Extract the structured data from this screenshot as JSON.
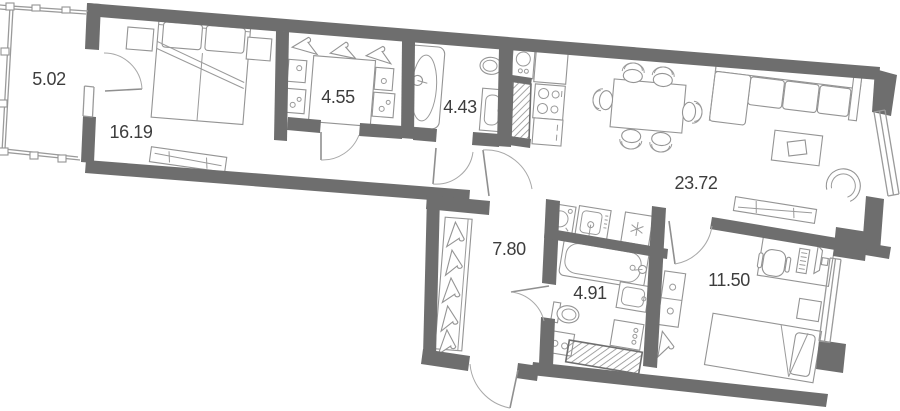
{
  "plan": {
    "type": "apartment-floor-plan",
    "rooms": [
      {
        "name": "balcony",
        "area_label": "5.02"
      },
      {
        "name": "bedroom",
        "area_label": "16.19"
      },
      {
        "name": "wardrobe",
        "area_label": "4.55"
      },
      {
        "name": "bathroom",
        "area_label": "4.43"
      },
      {
        "name": "living-room-kitchen",
        "area_label": "23.72"
      },
      {
        "name": "hallway",
        "area_label": "7.80"
      },
      {
        "name": "bathroom-2",
        "area_label": "4.91"
      },
      {
        "name": "bedroom-2",
        "area_label": "11.50"
      }
    ],
    "colors": {
      "wall": "#6e6e6e",
      "furniture_line": "#949494",
      "door_arc": "#a8a8a8",
      "label_text": "#3d3d3d",
      "background": "#ffffff"
    }
  }
}
